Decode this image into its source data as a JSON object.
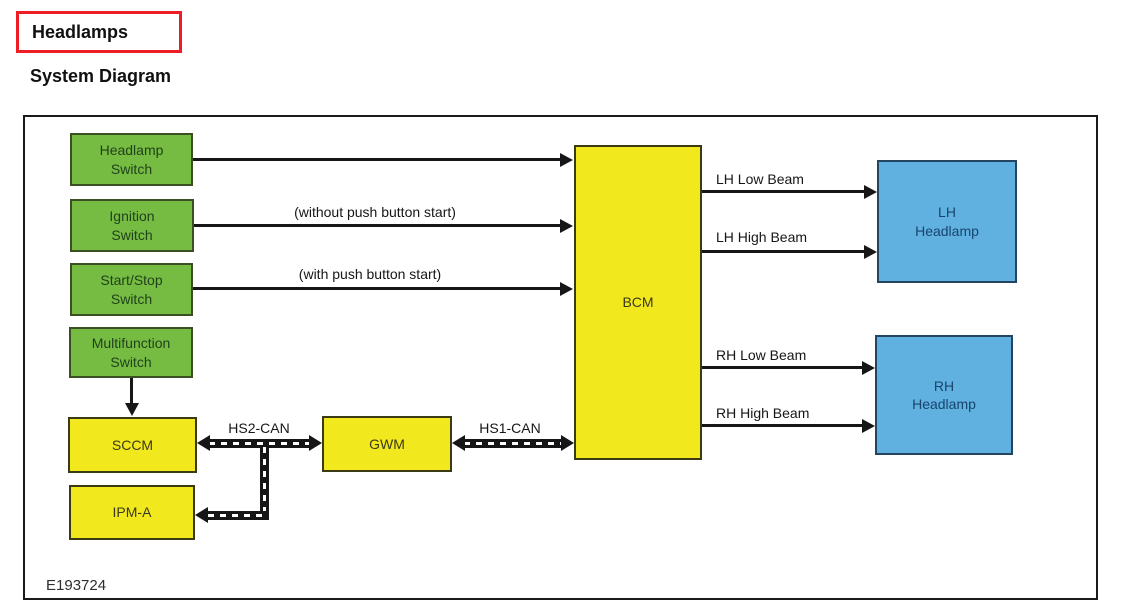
{
  "page": {
    "title": "Headlamps",
    "section_heading": "System Diagram",
    "figure_id": "E193724",
    "colors": {
      "title_border_red": "#ee1c25",
      "switch_green": "#76bc43",
      "module_yellow": "#f2e81e",
      "lamp_blue": "#60b0e0",
      "line_black": "#161616"
    }
  },
  "diagram": {
    "nodes": {
      "headlamp_switch": "Headlamp\nSwitch",
      "ignition_switch": "Ignition\nSwitch",
      "start_stop_switch": "Start/Stop\nSwitch",
      "multifunction_switch": "Multifunction\nSwitch",
      "sccm": "SCCM",
      "ipm_a": "IPM-A",
      "gwm": "GWM",
      "bcm": "BCM",
      "lh_headlamp": "LH\nHeadlamp",
      "rh_headlamp": "RH\nHeadlamp"
    },
    "labels": {
      "without_push_button_start": "(without push button start)",
      "with_push_button_start": "(with push button start)",
      "hs2_can": "HS2-CAN",
      "hs1_can": "HS1-CAN",
      "lh_low_beam": "LH Low Beam",
      "lh_high_beam": "LH High Beam",
      "rh_low_beam": "RH Low Beam",
      "rh_high_beam": "RH High Beam"
    }
  }
}
